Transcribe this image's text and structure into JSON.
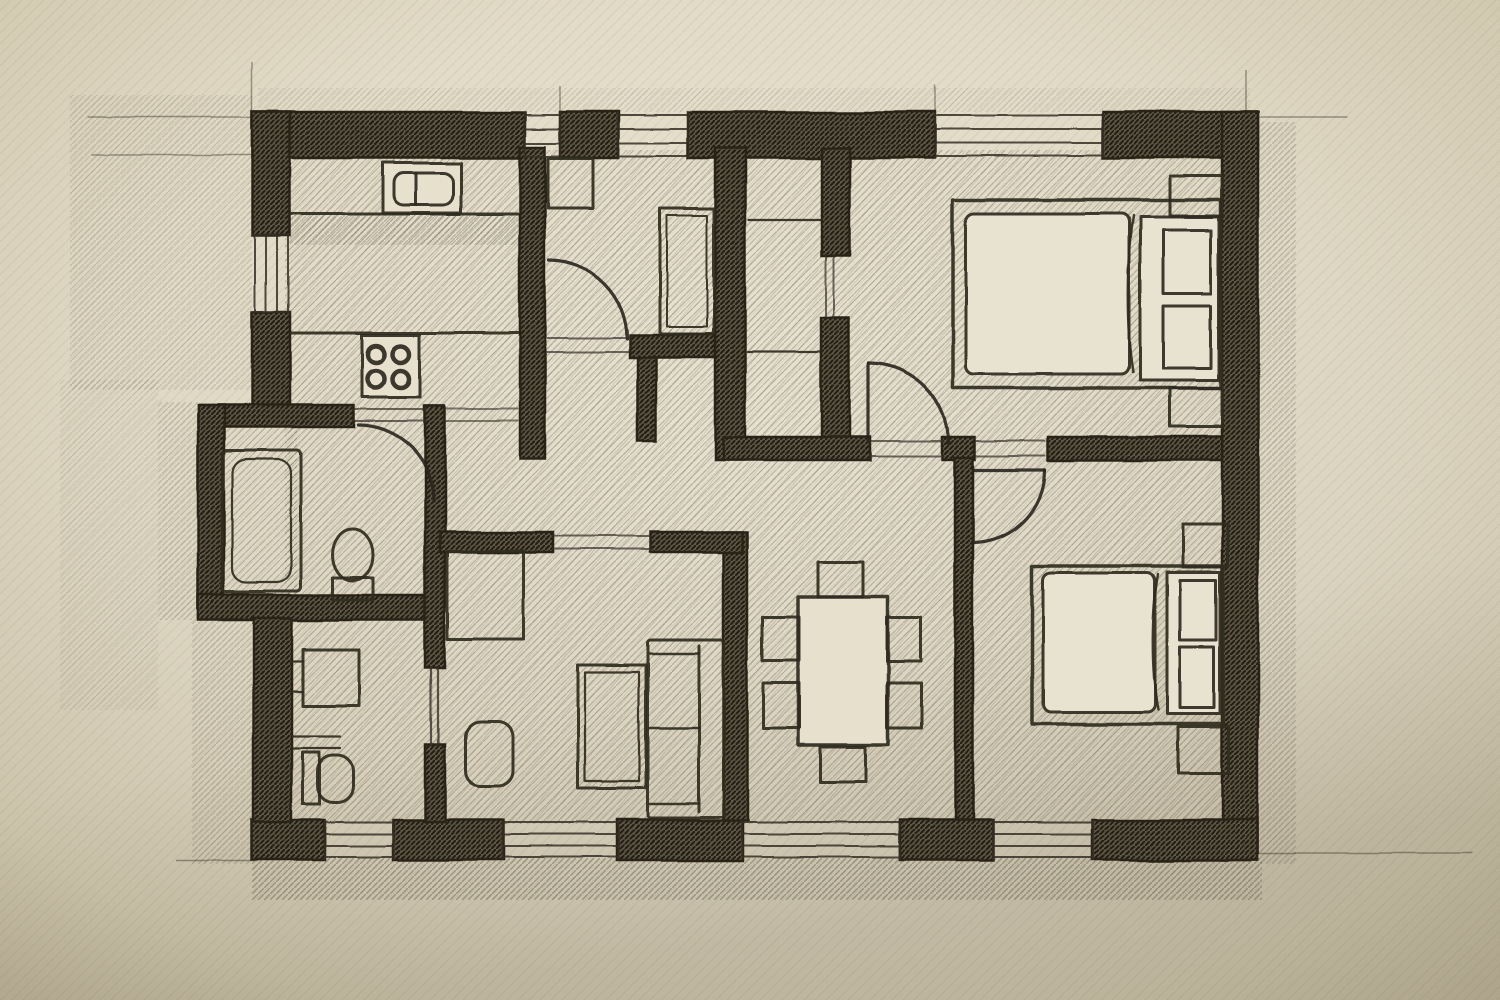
{
  "scene": {
    "description": "Hand-drawn pencil floor plan sketch of an apartment on warm beige paper",
    "style": "pencil sketch, cross-hatched poche walls, diagonal floor shading, door swing arcs",
    "visible_text": "none"
  },
  "colors": {
    "paper": "#e9e3d2",
    "paper_edge": "#c7bda6",
    "ink": "#2a2419",
    "wall_fill": "#5d5643",
    "wall_hatch": "#241e12",
    "floor_hatch": "#4b4334",
    "furniture": "#302a20",
    "shadow": "#322c1e"
  },
  "plan": {
    "rooms": [
      {
        "id": "kitchen",
        "position": "top-left",
        "furniture": [
          "sink-counter",
          "stove-4-burners",
          "worktop"
        ]
      },
      {
        "id": "small-room",
        "position": "top-middle",
        "furniture": [
          "desk",
          "wardrobe"
        ],
        "doors": 1
      },
      {
        "id": "closet",
        "position": "top-center",
        "furniture": [
          "shelves"
        ]
      },
      {
        "id": "bedroom-top-right",
        "furniture": [
          "double-bed",
          "pillows",
          "nightstand",
          "nightstand"
        ],
        "doors": 1,
        "windows": 1
      },
      {
        "id": "bathroom",
        "position": "middle-left",
        "furniture": [
          "bathtub",
          "toilet"
        ],
        "doors": 1
      },
      {
        "id": "wc",
        "position": "bottom-left",
        "furniture": [
          "wash-basin",
          "toilet",
          "shelf"
        ],
        "doors": 1,
        "windows": 1
      },
      {
        "id": "living-room",
        "position": "bottom-center-left",
        "furniture": [
          "sofa",
          "coffee-table",
          "armchair",
          "rug"
        ],
        "windows": 1
      },
      {
        "id": "dining-area",
        "position": "bottom-center",
        "furniture": [
          "dining-table",
          "six-chairs"
        ],
        "windows": 1
      },
      {
        "id": "bedroom-bottom-right",
        "furniture": [
          "double-bed",
          "pillows",
          "nightstand",
          "nightstand"
        ],
        "doors": 1,
        "windows": 1
      },
      {
        "id": "hallway",
        "position": "center",
        "furniture": []
      }
    ],
    "window_openings": 8,
    "door_swing_arcs": 4,
    "dining_chairs": 6,
    "beds": 2,
    "stove_burners": 4
  }
}
